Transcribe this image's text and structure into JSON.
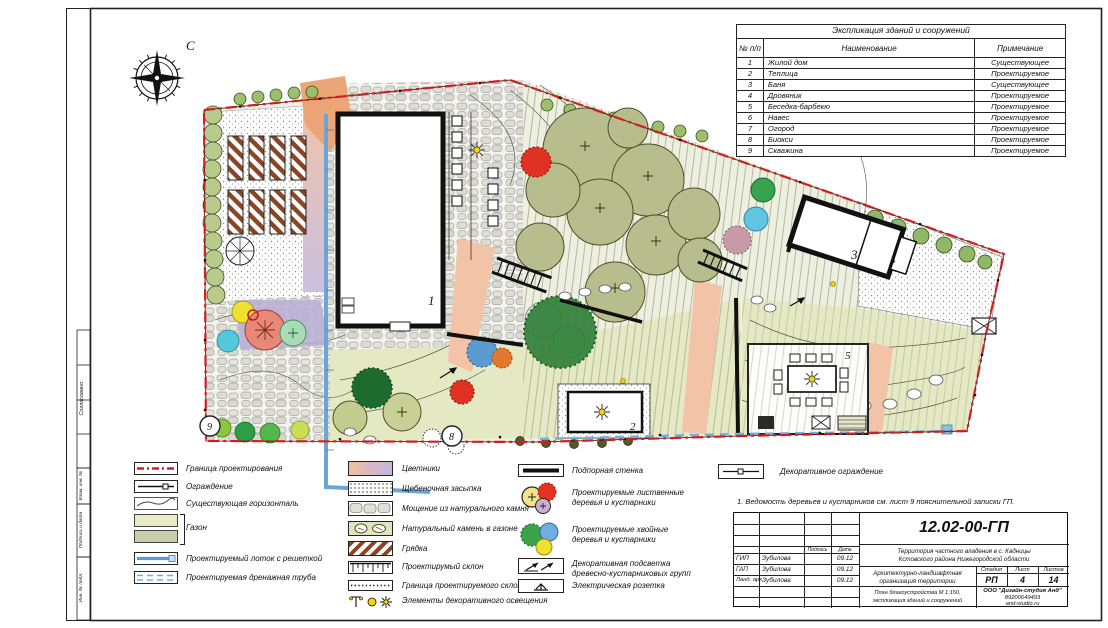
{
  "compass": {
    "north_label": "С"
  },
  "explication": {
    "title": "Экспликация зданий и сооружений",
    "col_num": "№ п/п",
    "col_name": "Наименование",
    "col_note": "Примечание",
    "rows": [
      {
        "num": "1",
        "name": "Жилой дом",
        "note": "Существующее"
      },
      {
        "num": "2",
        "name": "Теплица",
        "note": "Проектируемое"
      },
      {
        "num": "3",
        "name": "Баня",
        "note": "Существующее"
      },
      {
        "num": "4",
        "name": "Дровяник",
        "note": "Проектируемое"
      },
      {
        "num": "5",
        "name": "Беседка-барбекю",
        "note": "Проектируемое"
      },
      {
        "num": "6",
        "name": "Навес",
        "note": "Проектируемое"
      },
      {
        "num": "7",
        "name": "Огород",
        "note": "Проектируемое"
      },
      {
        "num": "8",
        "name": "Биокси",
        "note": "Проектируемое"
      },
      {
        "num": "9",
        "name": "Скважина",
        "note": "Проектируемое"
      }
    ]
  },
  "plan_labels": {
    "house": "1",
    "greenhouse": "2",
    "bath": "3",
    "woodshed": "4",
    "gazebo": "5",
    "bioksi": "8",
    "well": "9"
  },
  "legend": {
    "col1": [
      "Граница проектирования",
      "Ограждение",
      "Существующая горизонталь",
      "Газон",
      "Проектируемый лоток с решеткой",
      "Проектируемая дренажная труба"
    ],
    "col2": [
      "Цветники",
      "Щебеночная засыпка",
      "Мощение из натурального камня",
      "Натуральный камень в газоне",
      "Грядка",
      "Проектирумый склон",
      "Граница проектируемого склона",
      "Элементы декоративного освещения"
    ],
    "col3": [
      "Подпорная стенка",
      "Проектируемые лиственные деревья и кустарники",
      "Проектируемые хвойные деревья и кустарники",
      "Декоративная подсветка древесно-кустарниковых групп",
      "Электрическая розетка"
    ],
    "col4": [
      "Декоративное ограждение"
    ]
  },
  "note": "1. Ведомость деревьев и кустарников см. лист 9 пояснительной записки ГП.",
  "stamp": {
    "doc_number": "12.02-00-ГП",
    "territory1": "Территория частного владения в с. Кадницы",
    "territory2": "Кстовского района Нижегородской области",
    "hdr_sign": "Подпись",
    "hdr_date": "Дата",
    "sig_rows": [
      {
        "role": "ГИП",
        "name": "Зубилова",
        "date": "09.12"
      },
      {
        "role": "ГАП",
        "name": "Зубилова",
        "date": "09.12"
      },
      {
        "role": "Ланд. арх.",
        "name": "Зубилова",
        "date": "09.12"
      }
    ],
    "project_title": "Архитектурно-ландшафтная организация территории",
    "sheet_title1": "План благоустройства М 1:150,",
    "sheet_title2": "экспликация зданий и сооружений",
    "stage_label": "Стадия",
    "list_label": "Лист",
    "lists_label": "Листов",
    "stage": "РП",
    "list": "4",
    "lists": "14",
    "company1": "ООО \"Дизайн-студия Анд\"",
    "company2": "89200649493",
    "company3": "and-studio.ru"
  },
  "frame": {
    "approved": "Согласовано:",
    "vzam": "Взам. инв. №",
    "podp": "Подпись и дата",
    "inv": "Инв. № подл."
  },
  "colors": {
    "boundary_red": "#d11f1f",
    "water_blue": "#6aa5d8",
    "lawn": "#e4e8c3",
    "canopy": "#b7bd8c"
  }
}
